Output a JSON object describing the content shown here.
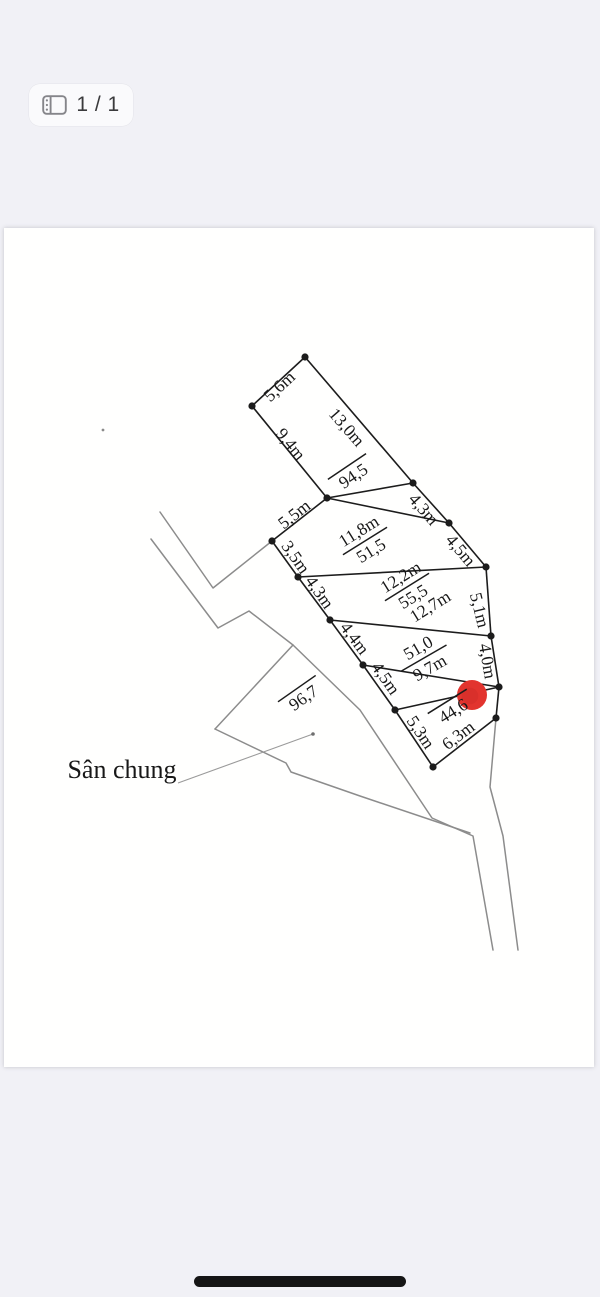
{
  "page_indicator": {
    "label": "1 / 1",
    "icon": "pages-icon"
  },
  "home_indicator": {
    "color": "#151515"
  },
  "document": {
    "x": 4,
    "y": 228,
    "w": 590,
    "h": 839,
    "bg": "#fffffe"
  },
  "drawing": {
    "ink": "#1c1c1c",
    "road_color": "#8c8c8c",
    "leader_color": "#9a9a9a",
    "marker_color": "#e2342e",
    "label_font_size": 17.5,
    "note_font_size": 26,
    "vertices": {
      "A": [
        305,
        357
      ],
      "B": [
        252,
        406
      ],
      "C": [
        327,
        498
      ],
      "D": [
        413,
        483
      ],
      "E": [
        449,
        523
      ],
      "F": [
        272,
        541
      ],
      "G": [
        298,
        577
      ],
      "H": [
        486,
        567
      ],
      "I": [
        330,
        620
      ],
      "J": [
        363,
        665
      ],
      "K": [
        491,
        636
      ],
      "L": [
        395,
        710
      ],
      "M": [
        499,
        687
      ],
      "N": [
        496,
        718
      ],
      "O": [
        433,
        767
      ]
    },
    "edges": [
      [
        "A",
        "B"
      ],
      [
        "B",
        "C"
      ],
      [
        "A",
        "D"
      ],
      [
        "C",
        "D"
      ],
      [
        "D",
        "E"
      ],
      [
        "C",
        "E"
      ],
      [
        "C",
        "F"
      ],
      [
        "F",
        "G"
      ],
      [
        "E",
        "H"
      ],
      [
        "G",
        "H"
      ],
      [
        "G",
        "I"
      ],
      [
        "H",
        "K"
      ],
      [
        "I",
        "K"
      ],
      [
        "I",
        "J"
      ],
      [
        "J",
        "M"
      ],
      [
        "K",
        "M"
      ],
      [
        "J",
        "L"
      ],
      [
        "L",
        "M"
      ],
      [
        "M",
        "N"
      ],
      [
        "L",
        "O"
      ],
      [
        "O",
        "N"
      ]
    ],
    "roads": [
      [
        [
          160,
          512
        ],
        [
          213,
          588
        ],
        [
          272,
          541
        ]
      ],
      [
        [
          151,
          539
        ],
        [
          218,
          628
        ],
        [
          249,
          611
        ],
        [
          293,
          645
        ],
        [
          360,
          710
        ],
        [
          432,
          818
        ],
        [
          473,
          836
        ],
        [
          493,
          950
        ]
      ],
      [
        [
          293,
          645
        ],
        [
          215,
          729
        ]
      ],
      [
        [
          215,
          729
        ],
        [
          286,
          763
        ],
        [
          291,
          772
        ],
        [
          360,
          796
        ],
        [
          470,
          833
        ]
      ],
      [
        [
          496,
          718
        ],
        [
          490,
          787
        ],
        [
          503,
          836
        ],
        [
          518,
          950
        ]
      ]
    ],
    "leader": {
      "points": [
        [
          178,
          783
        ],
        [
          313,
          734
        ]
      ],
      "end_dot": [
        313,
        734
      ]
    },
    "marker": {
      "x": 472,
      "y": 695,
      "r": 15
    },
    "speck": {
      "x": 103,
      "y": 430
    },
    "dim_labels": [
      {
        "text": "5,6m",
        "x": 279,
        "y": 386,
        "rot": -43
      },
      {
        "text": "9,4m",
        "x": 291,
        "y": 444,
        "rot": 51
      },
      {
        "text": "13,0m",
        "x": 347,
        "y": 427,
        "rot": 49
      },
      {
        "text": "5,5m",
        "x": 294,
        "y": 514,
        "rot": -38
      },
      {
        "text": "4,3m",
        "x": 424,
        "y": 509,
        "rot": 49
      },
      {
        "text": "3,5m",
        "x": 296,
        "y": 557,
        "rot": 55
      },
      {
        "text": "4,5m",
        "x": 461,
        "y": 550,
        "rot": 50
      },
      {
        "text": "4,3m",
        "x": 320,
        "y": 592,
        "rot": 55
      },
      {
        "text": "5,1m",
        "x": 480,
        "y": 610,
        "rot": 76
      },
      {
        "text": "4,4m",
        "x": 355,
        "y": 638,
        "rot": 53
      },
      {
        "text": "4,0m",
        "x": 488,
        "y": 661,
        "rot": 80
      },
      {
        "text": "4,5m",
        "x": 386,
        "y": 678,
        "rot": 55
      },
      {
        "text": "5,3m",
        "x": 421,
        "y": 732,
        "rot": 56
      },
      {
        "text": "6,3m",
        "x": 458,
        "y": 735,
        "rot": -37
      },
      {
        "text": "12,7m",
        "x": 430,
        "y": 606,
        "rot": -32
      }
    ],
    "area_labels": [
      {
        "above": "",
        "below": "94,5",
        "x": 352,
        "y": 474,
        "rot": -34
      },
      {
        "above": "11,8m",
        "below": "51,5",
        "x": 365,
        "y": 541,
        "rot": -32
      },
      {
        "above": "12,2m",
        "below": "55,5",
        "x": 407,
        "y": 587,
        "rot": -32
      },
      {
        "above": "51,0",
        "below": "9,7m",
        "x": 424,
        "y": 658,
        "rot": -30
      },
      {
        "above": "",
        "below": "44,6",
        "x": 452,
        "y": 709,
        "rot": -32
      },
      {
        "above": "",
        "below": "96,7",
        "x": 302,
        "y": 696,
        "rot": -35
      }
    ],
    "note": {
      "text": "Sân chung",
      "x": 122,
      "y": 778
    }
  }
}
